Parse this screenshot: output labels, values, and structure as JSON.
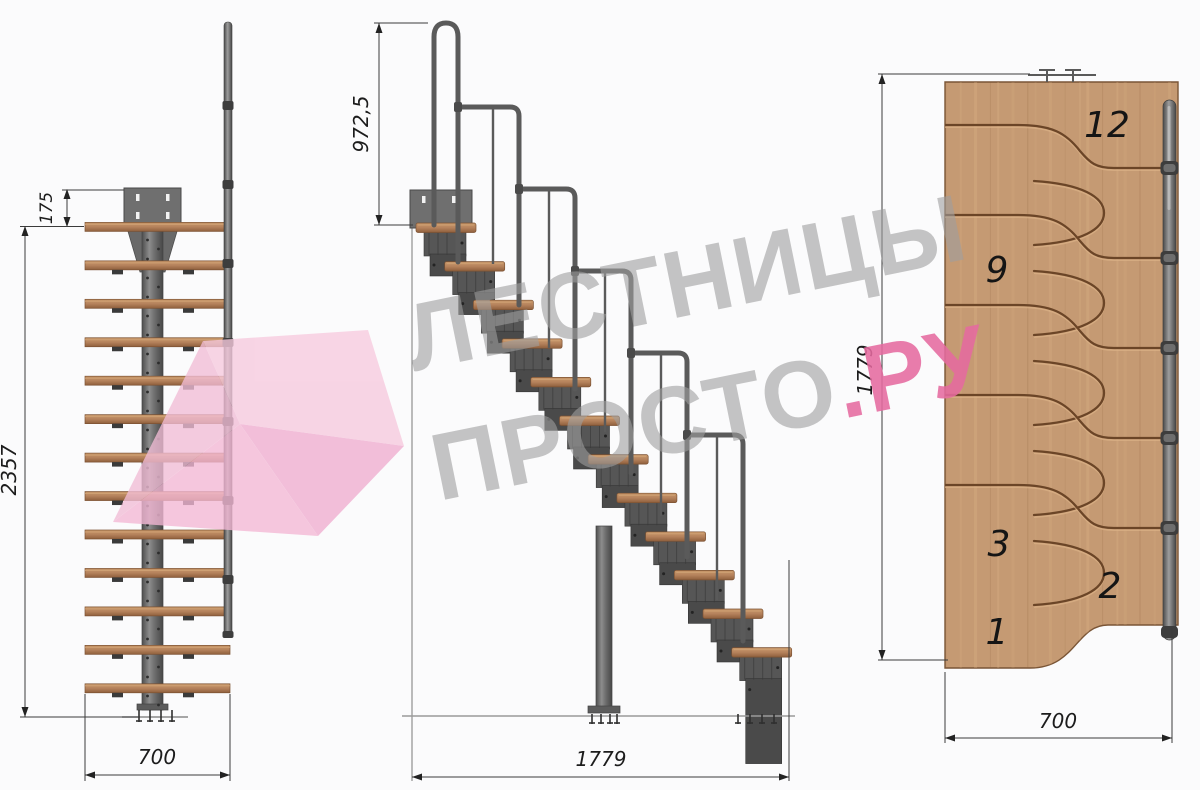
{
  "drawing": {
    "front_view": {
      "dim_plate_height": "175",
      "dim_total_height": "2357",
      "dim_width": "700"
    },
    "side_view": {
      "dim_handrail_height": "972,5",
      "dim_length": "1779"
    },
    "plan_view": {
      "dim_length": "1779",
      "dim_width": "700",
      "step_12": "12",
      "step_9": "9",
      "step_3": "3",
      "step_2": "2",
      "step_1": "1"
    },
    "watermark": {
      "word_top": "ЛЕСТНИЦЫ",
      "word_bottom": "ПРОСТО",
      "word_suffix": ".РУ"
    },
    "colors": {
      "wood_plan": "#c59a73",
      "wood_tread": "#b5825c",
      "metal": "#5f5f5f",
      "accent_pink": "#e56a9f",
      "watermark_gray": "#a0a0a0"
    }
  }
}
